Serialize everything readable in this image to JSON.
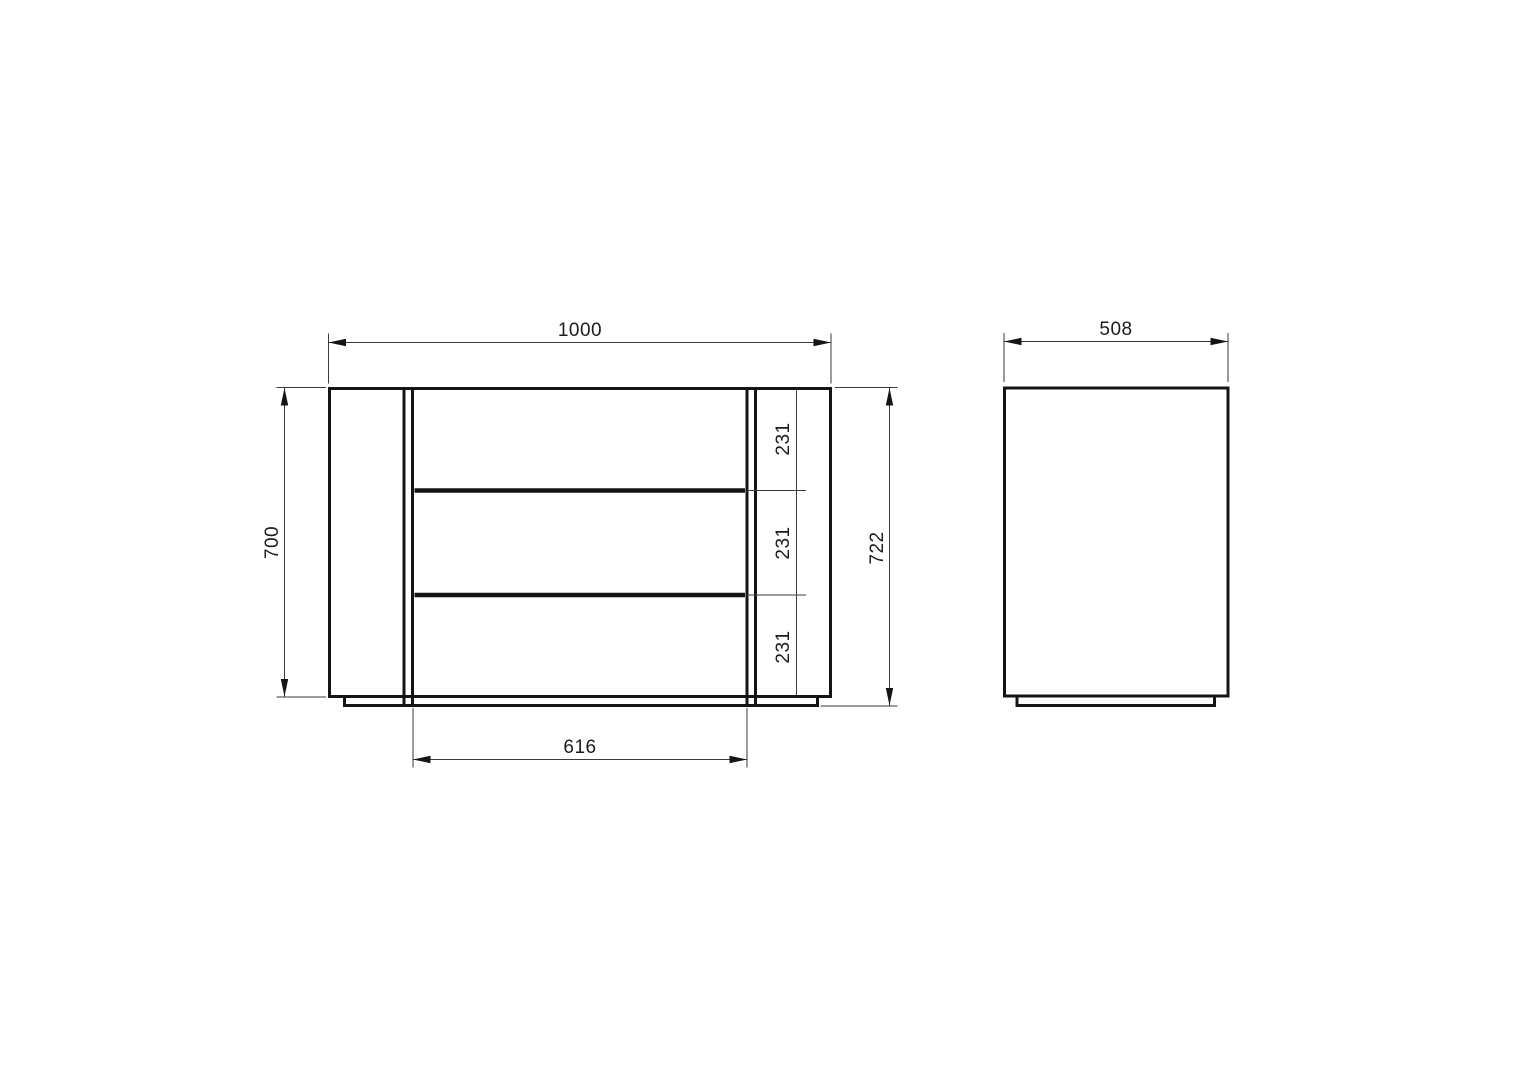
{
  "front_view": {
    "overall_width": "1000",
    "carcass_height": "700",
    "overall_height": "722",
    "drawer_opening_width": "616",
    "drawer_front_heights": [
      "231",
      "231",
      "231"
    ]
  },
  "side_view": {
    "depth": "508"
  },
  "colors": {
    "line": "#151515",
    "dimension_line": "#3a3a3a",
    "background": "#ffffff"
  }
}
